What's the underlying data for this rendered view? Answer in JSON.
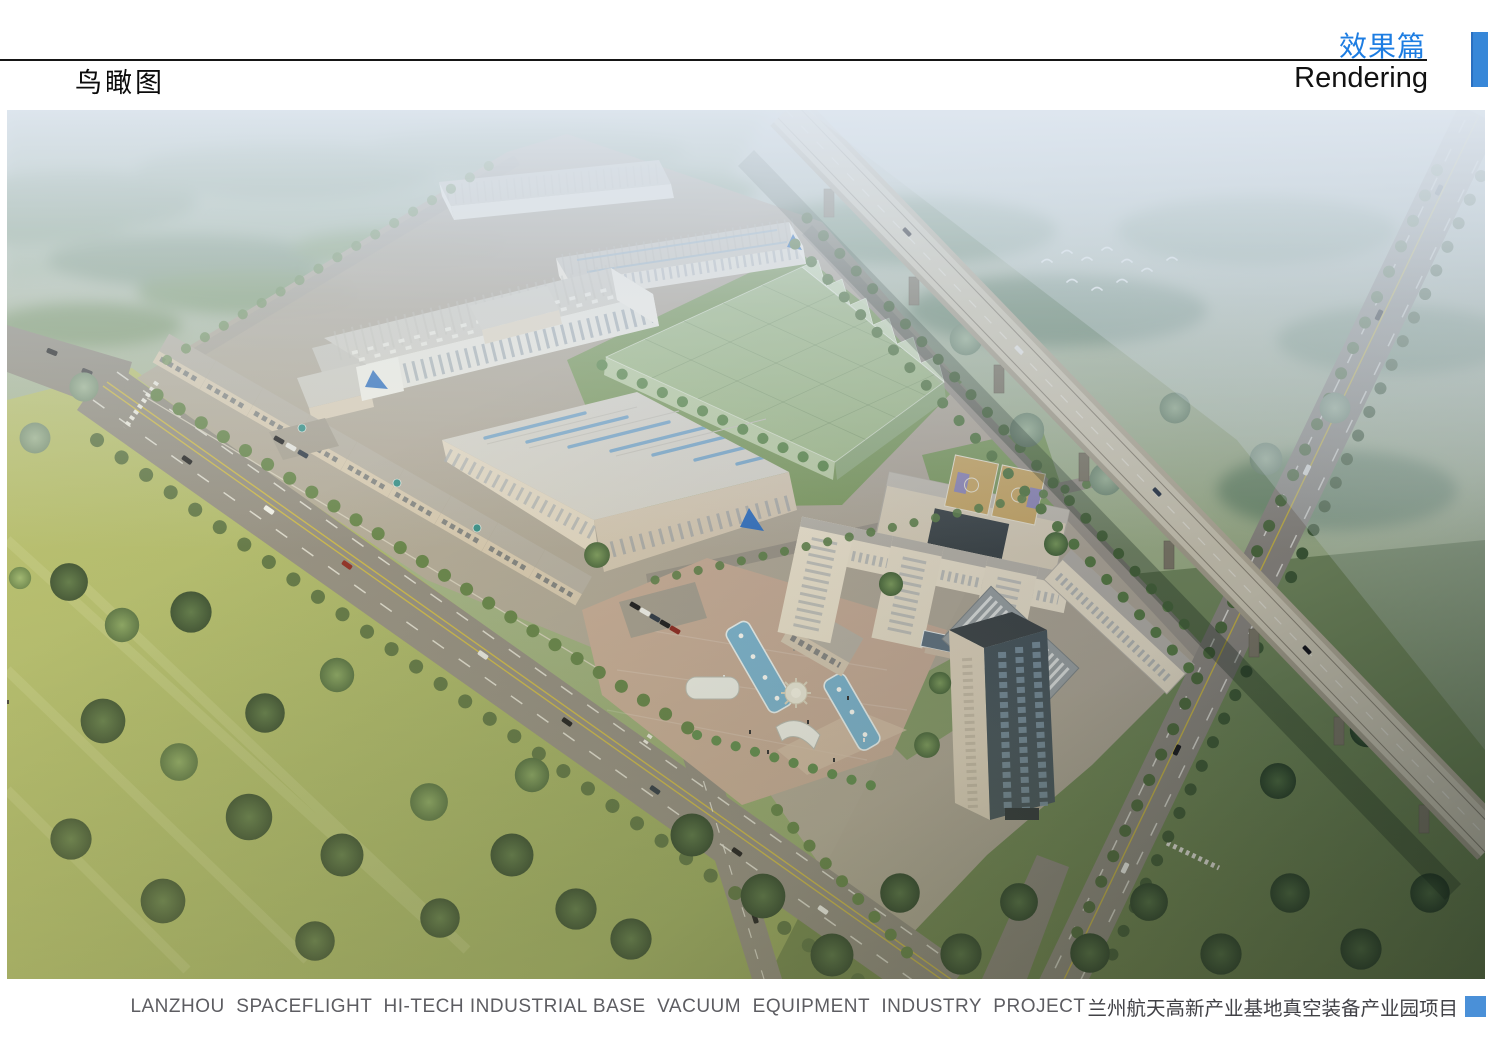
{
  "header": {
    "section_title_zh": "效果篇",
    "section_title_en": "Rendering",
    "page_title": "鸟瞰图",
    "accent_color": "#3787d8"
  },
  "figure": {
    "type": "aerial-architectural-rendering",
    "scene_elements": [
      "factory-halls",
      "planned-greenhouse-volume",
      "workshop-row",
      "office-building",
      "dormitory-courtyard",
      "basketball-courts",
      "high-rise-tower",
      "entrance-plaza",
      "fountain-pools",
      "red-flag",
      "main-boulevard",
      "elevated-expressway",
      "east-road",
      "tree-belts",
      "birds"
    ]
  },
  "footer": {
    "caption_en": "LANZHOU  SPACEFLIGHT  HI-TECH INDUSTRIAL BASE  VACUUM  EQUIPMENT  INDUSTRY  PROJECT",
    "caption_zh": "兰州航天高新产业基地真空装备产业园项目",
    "marker_color": "#4a90d8"
  }
}
